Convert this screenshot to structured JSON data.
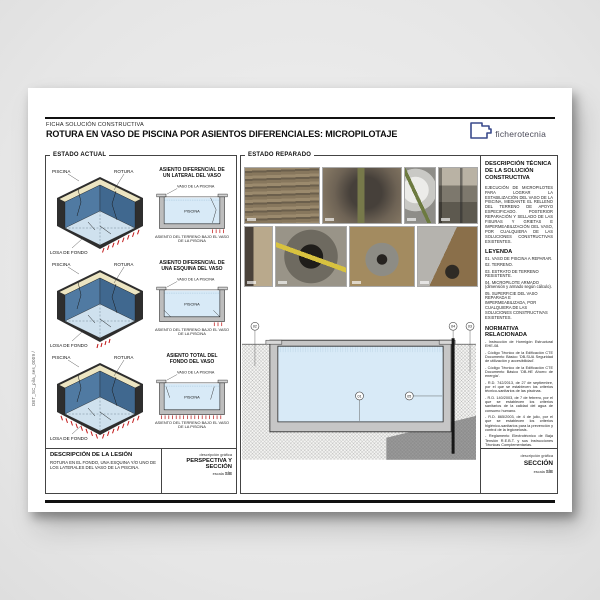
{
  "page": {
    "kicker": "FICHA SOLUCIÓN CONSTRUCTIVA",
    "title": "ROTURA EN VASO DE PISCINA POR ASIENTOS DIFERENCIALES: MICROPILOTAJE",
    "logo": "ficherotecnia",
    "doc_code": "DET_SC_pila_ses_0009 /"
  },
  "estado_actual": {
    "heading": "ESTADO ACTUAL",
    "iso_labels": {
      "piscina": "PISCINA",
      "rotura": "ROTURA",
      "losa": "LOSA DE FONDO"
    },
    "rows": [
      {
        "sketch_title_1": "ASIENTO DIFERENCIAL DE",
        "sketch_title_2": "UN LATERAL DEL VASO",
        "vaso_label": "VASO DE LA PISCINA",
        "water_label": "PISCINA",
        "caption": "ASIENTO DEL TERRENO BAJO EL VASO DE LA PISCINA"
      },
      {
        "sketch_title_1": "ASIENTO DIFERENCIAL DE",
        "sketch_title_2": "UNA ESQUINA DEL VASO",
        "vaso_label": "VASO DE LA PISCINA",
        "water_label": "PISCINA",
        "caption": "ASIENTO DEL TERRENO BAJO EL VASO DE LA PISCINA"
      },
      {
        "sketch_title_1": "ASIENTO TOTAL DEL",
        "sketch_title_2": "FONDO DEL VASO",
        "vaso_label": "VASO DE LA PISCINA",
        "water_label": "PISCINA",
        "caption": "ASIENTO DEL TERRENO BAJO EL VASO DE LA PISCINA"
      }
    ],
    "lesion": {
      "heading": "DESCRIPCIÓN DE LA LESIÓN",
      "text": "ROTURA EN EL FONDO, UNA ESQUINA Y/O UNO DE LOS LATERALES DEL VASO DE LA PISCINA.",
      "graphic_label": "descripción gráfica",
      "graphic_title": "PERSPECTIVA Y SECCIÓN",
      "scale_label": "escala",
      "scale_value": "S/E"
    }
  },
  "estado_reparado": {
    "heading": "ESTADO REPARADO",
    "photos": [
      "micropile-tubes-stack",
      "excavated-pile-head",
      "large-pipe-section",
      "drilling-equipment",
      "wall-pile-corner",
      "borehole-with-measuring-tape",
      "micropile-borehole",
      "wall-repair-hole"
    ]
  },
  "seccion": {
    "callouts": {
      "c01": "01",
      "c02": "02",
      "c03": "03",
      "c04": "04",
      "c05": "05"
    },
    "footer": {
      "graphic_label": "descripción gráfica",
      "graphic_title": "SECCIÓN",
      "scale_label": "escala",
      "scale_value": "S/E"
    }
  },
  "solucion": {
    "heading": "DESCRIPCIÓN TÉCNICA DE LA SOLUCIÓN CONSTRUCTIVA",
    "body": "EJECUCIÓN DE MICROPILOTES PARA LOGRAR LA ESTABILIZACIÓN DEL VASO DE LA PISCINA, MEDIANTE EL RELLENO DEL TERRENO DE APOYO ESPECIFICADO. POSTERIOR REPARACIÓN Y SELLADO DE LAS FISURAS Y GRIETAS E IMPERMEABILIZACIÓN DEL VASO, POR CUALQUIERA DE LAS SOLUCIONES CONSTRUCTIVAS EXISTENTES.",
    "leyenda_heading": "LEYENDA",
    "leyenda_items": [
      "01. VASO DE PISCINA A REPARAR.",
      "02. TERRENO.",
      "03. ESTRATO DE TERRENO RESISTENTE.",
      "04. MICROPILOTE ARMADO (dimensión y armado según cálculo).",
      "05. SUPERFICIE DEL VASO REPARADA E IMPERMEABILIZADA, POR CUALQUIERA DE LAS SOLUCIONES CONSTRUCTIVAS EXISTENTES."
    ],
    "normativa_heading": "NORMATIVA RELACIONADA",
    "normativa_items": [
      "- Instrucción de Hormigón Estructural EHE-08.",
      "- Código Técnico de la Edificación CTE Documento Básico 'DB-SUA Seguridad de utilización y accesibilidad'.",
      "- Código Técnico de la Edificación CTE Documento Básico 'DB-HE Ahorro de energía'.",
      "- R.D. 742/2013, de 27 de septiembre, por el que se establecen los criterios técnico-sanitarios de las piscinas.",
      "- R.D. 140/2003, de 7 de febrero, por el que se establecen los criterios sanitarios de la calidad del agua de consumo humano.",
      "- R.D. 865/2003, de 4 de julio, por el que se establecen los criterios higiénico-sanitarios para la prevención y control de la legionelosis.",
      "- Reglamento Electrotécnico de Baja Tensión R.E.B.T. y sus Instrucciones Técnicas Complementarias.",
      "- Normas 'UNE' de materiales y productos de construcción con especificaciones técnicas y ensayos.",
      "- Pliego general de condiciones para la recepción de conglomerantes RC-08."
    ]
  },
  "colors": {
    "accent_red": "#c11818",
    "pool_wall_blue": "#507aa2",
    "water_blue": "#d8eaf7",
    "coping_cream": "#ece5c2",
    "logo_navy": "#3a4a8c"
  }
}
